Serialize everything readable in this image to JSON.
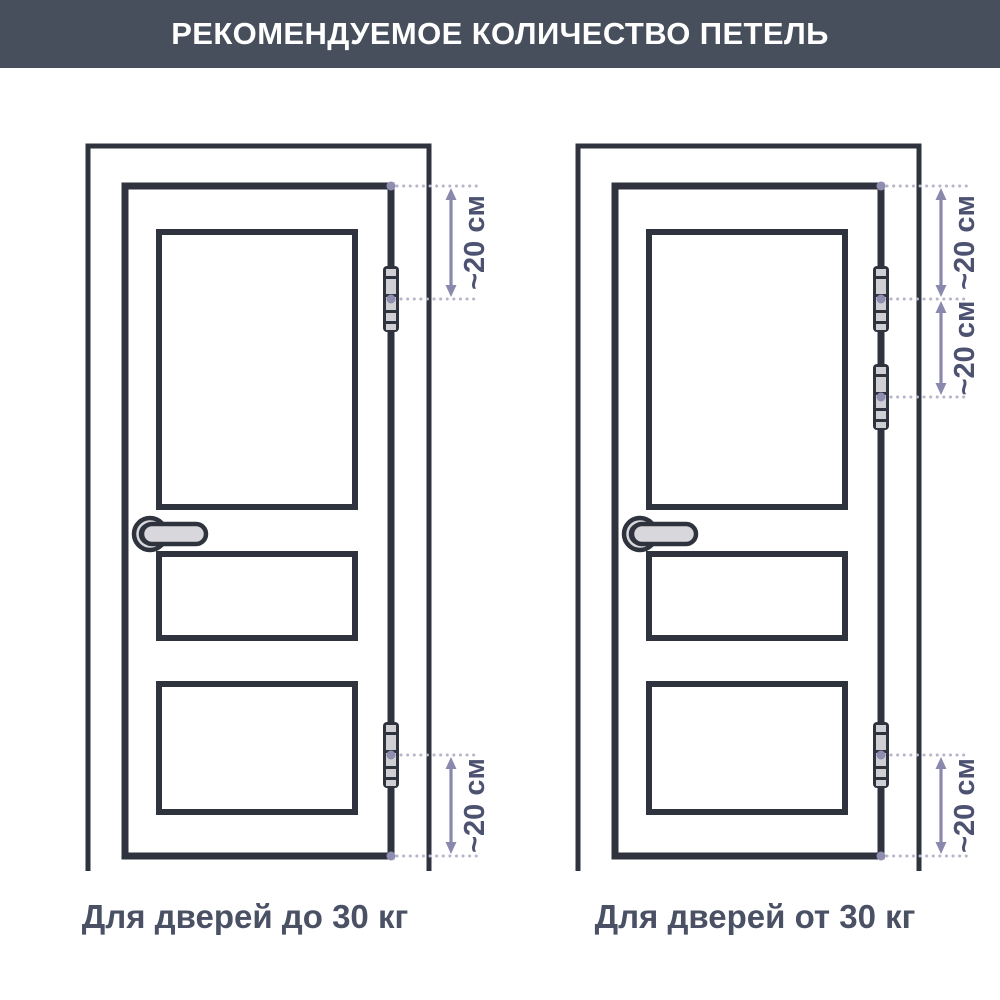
{
  "header": {
    "title": "РЕКОМЕНДУЕМОЕ КОЛИЧЕСТВО ПЕТЕЛЬ"
  },
  "figures": [
    {
      "id": "door-up-to-30kg",
      "caption": "Для дверей до 30 кг",
      "hinge_count": 2,
      "dimensions": [
        {
          "position": "top-of-door-to-upper-hinge",
          "label": "~20 см"
        },
        {
          "position": "lower-hinge-to-bottom-of-door",
          "label": "~20 см"
        }
      ]
    },
    {
      "id": "door-over-30kg",
      "caption": "Для дверей от 30 кг",
      "hinge_count": 3,
      "dimensions": [
        {
          "position": "top-of-door-to-upper-hinge",
          "label": "~20 см"
        },
        {
          "position": "upper-hinge-to-middle-hinge",
          "label": "~20 см"
        },
        {
          "position": "lower-hinge-to-bottom-of-door",
          "label": "~20 см"
        }
      ]
    }
  ],
  "colors": {
    "header_bg": "#474e5c",
    "header_text": "#ffffff",
    "line": "#2e333e",
    "caption_text": "#4a5165",
    "dimension_text": "#4c5270",
    "arrow": "#8a88ad",
    "leader_dot": "#8f8db0",
    "dotted_leader": "#b7b5c9",
    "hardware_fill": "#d8d8dc"
  }
}
